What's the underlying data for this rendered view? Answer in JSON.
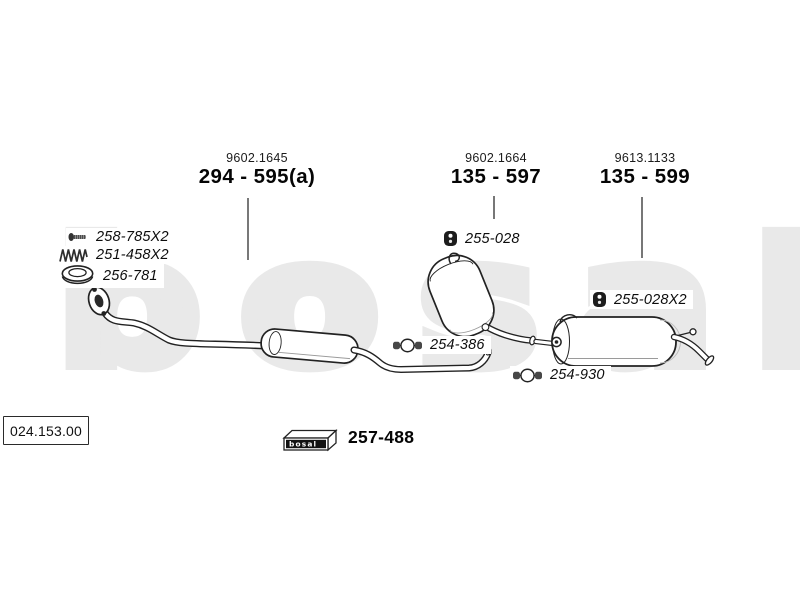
{
  "colors": {
    "background": "#ffffff",
    "line_art": "#222222",
    "watermark": "#e9e9e9",
    "text": "#111111"
  },
  "watermark": {
    "text": "bosal"
  },
  "assemblies": [
    {
      "code": "9602.1645",
      "number": "294 - 595(a)"
    },
    {
      "code": "9602.1664",
      "number": "135 - 597"
    },
    {
      "code": "9613.1133",
      "number": "135 - 599"
    }
  ],
  "parts": [
    {
      "label": "258-785X2",
      "icon": "bolt-icon"
    },
    {
      "label": "251-458X2",
      "icon": "spring-icon"
    },
    {
      "label": "256-781",
      "icon": "gasket-ring-icon"
    },
    {
      "label": "255-028",
      "icon": "rubber-hanger-icon"
    },
    {
      "label": "255-028X2",
      "icon": "rubber-hanger-icon"
    },
    {
      "label": "254-386",
      "icon": "pipe-clamp-icon"
    },
    {
      "label": "254-930",
      "icon": "pipe-clamp-icon"
    }
  ],
  "kit_box": {
    "brand": "bosal",
    "number": "257-488",
    "icon": "bosal-box-icon"
  },
  "reference": {
    "number": "024.153.00"
  }
}
